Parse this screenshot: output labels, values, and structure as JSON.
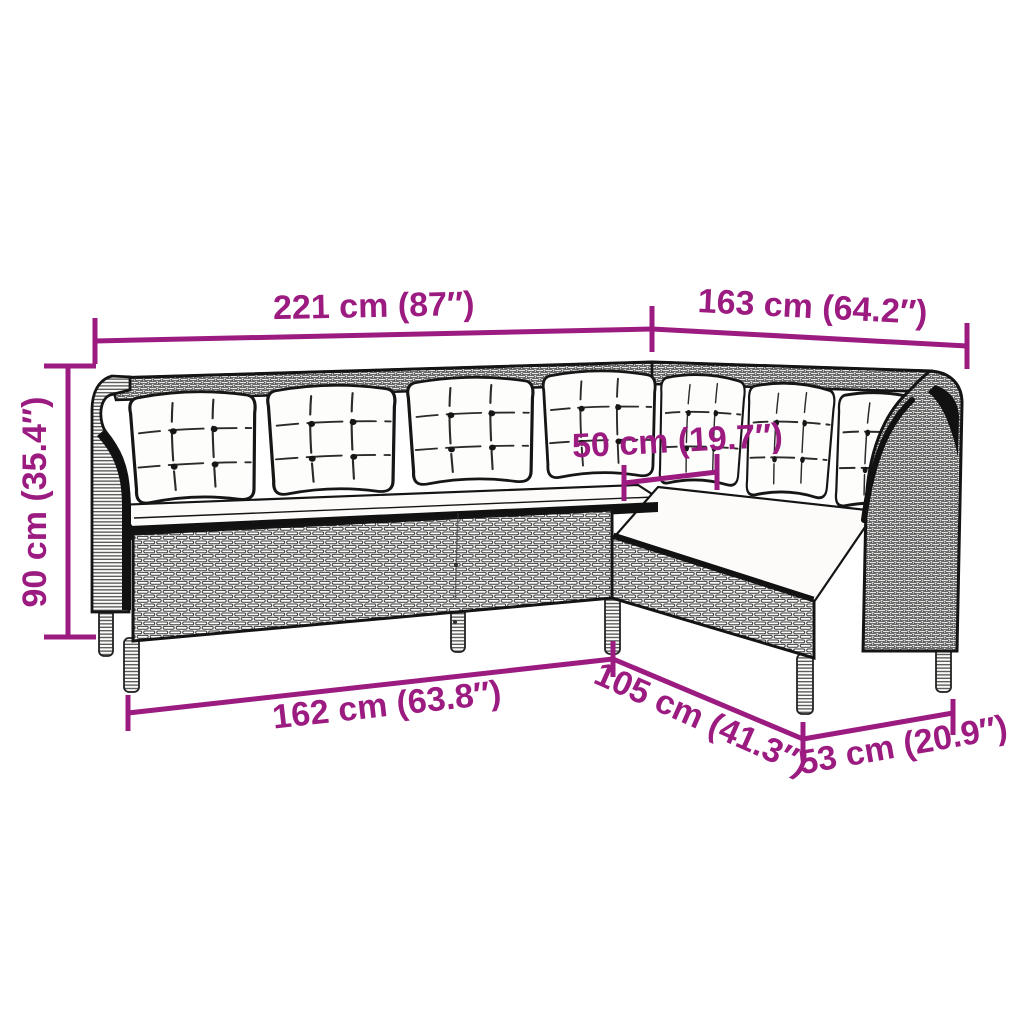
{
  "diagram": {
    "type": "product-dimension-diagram",
    "subject": "rattan L-shaped corner sofa with cushions",
    "style": "black and white line art with magenta measurements",
    "accent_color": "#9b1b80",
    "line_color": "#141414",
    "background_color": "#ffffff",
    "dimensions": {
      "back_width_left": "221 cm (87″)",
      "back_width_right": "163 cm (64.2″)",
      "overall_height": "90 cm (35.4″)",
      "seat_depth": "50 cm (19.7″)",
      "front_width_left": "162 cm (63.8″)",
      "front_depth_diagonal": "105 cm (41.3″)",
      "front_width_right": "53 cm (20.9″)"
    }
  }
}
